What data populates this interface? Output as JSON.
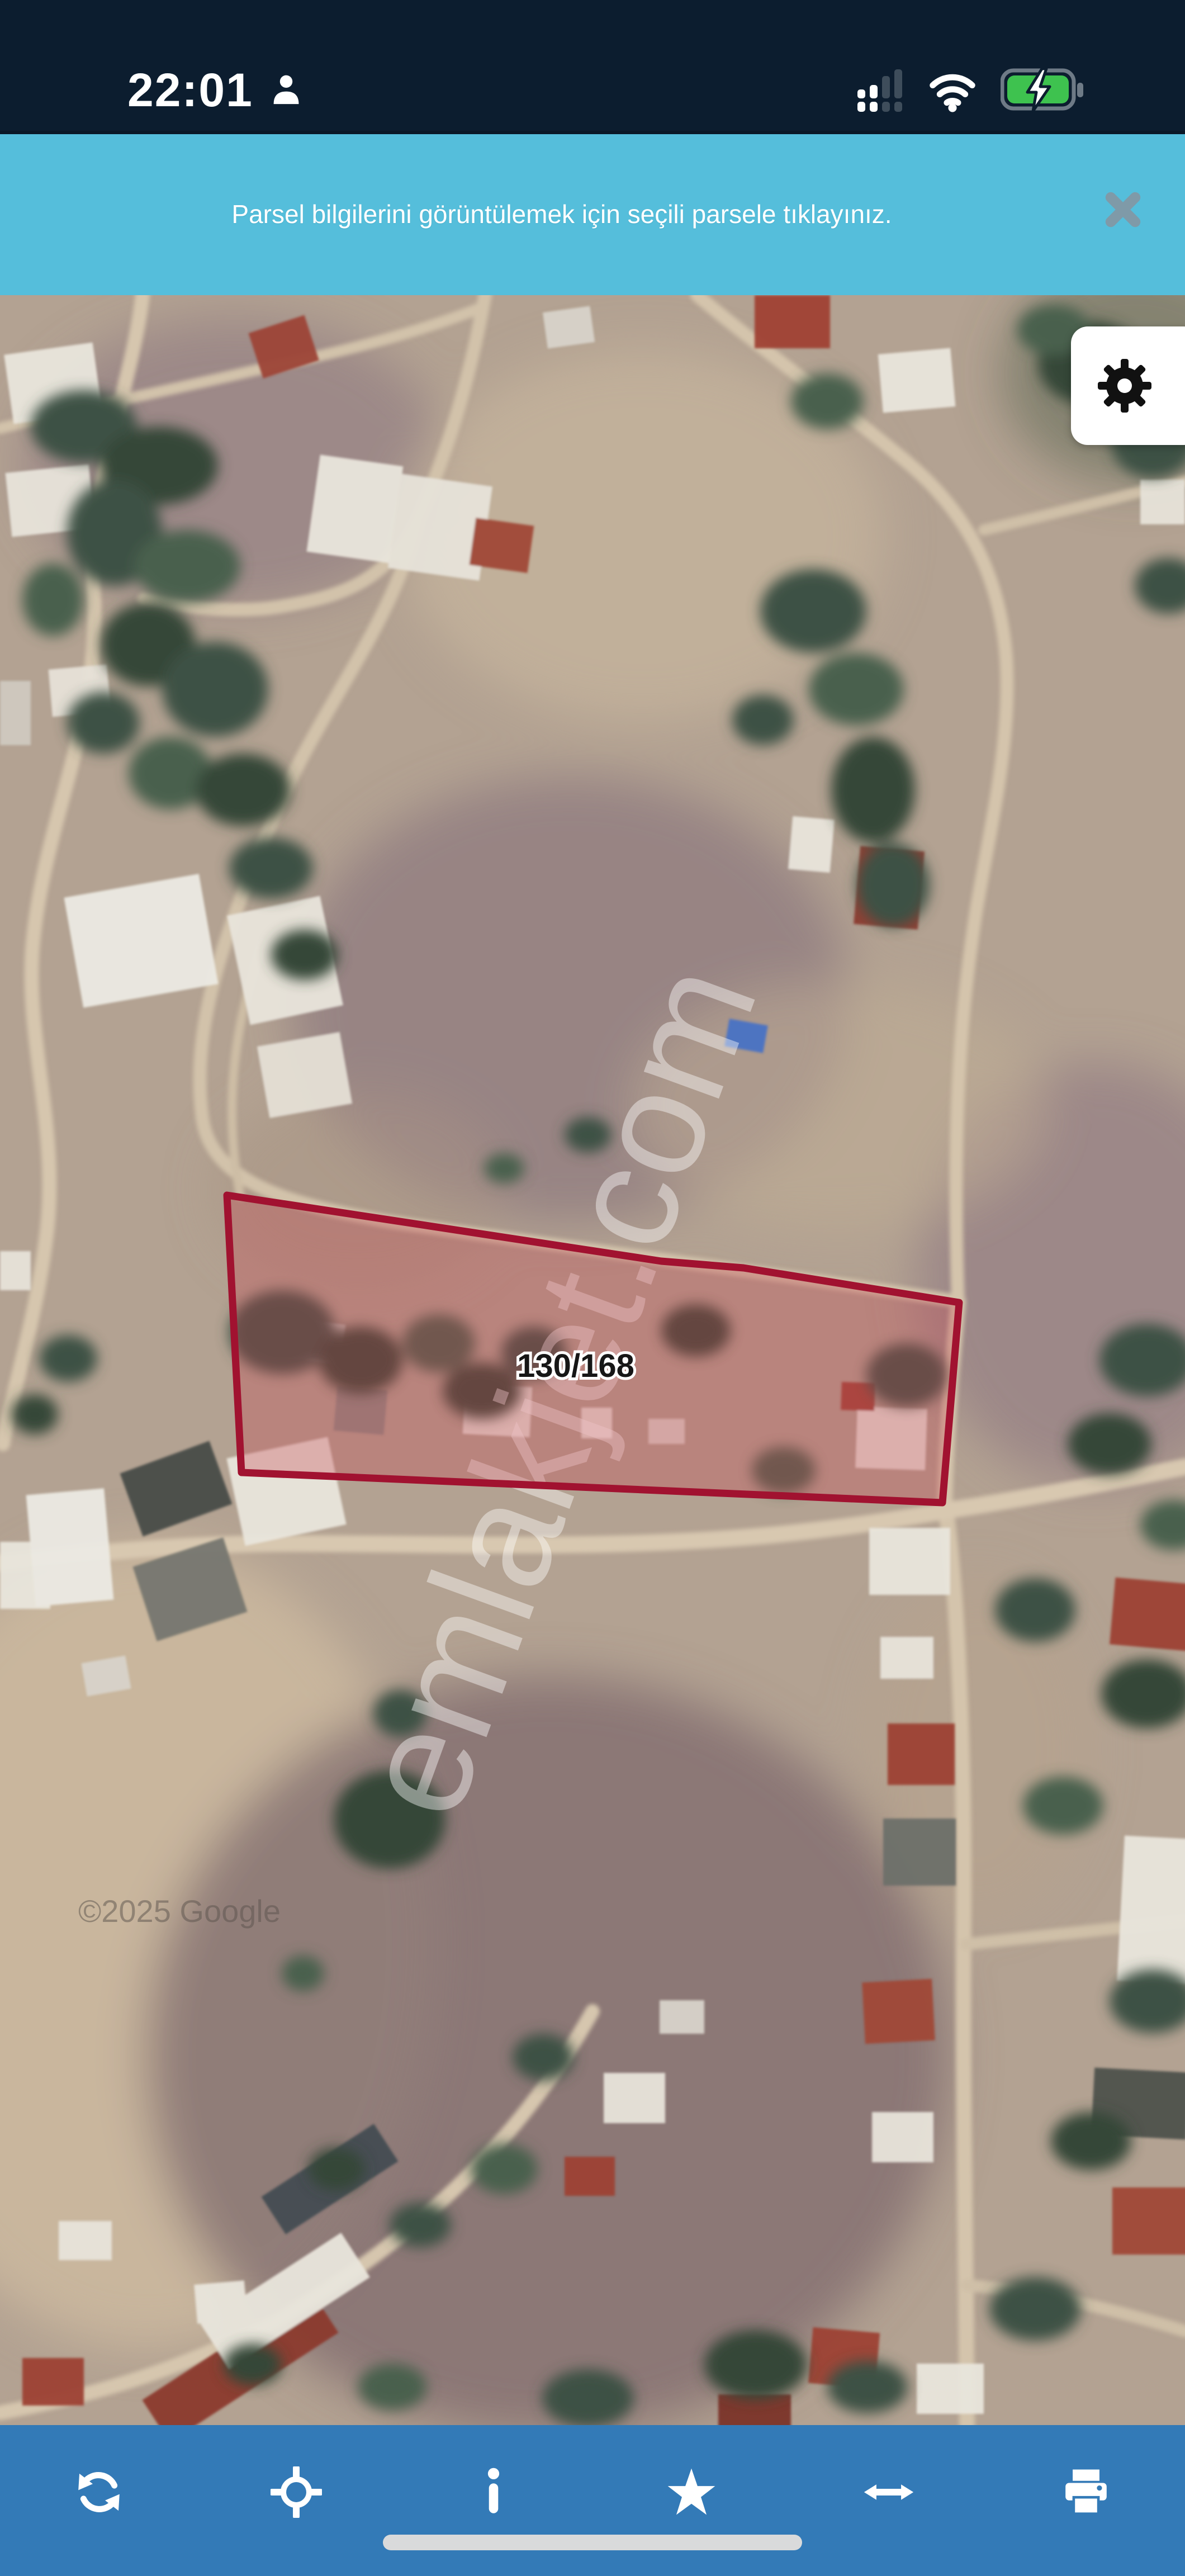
{
  "status_bar": {
    "time": "22:01",
    "icons": [
      {
        "name": "user-icon"
      },
      {
        "name": "cellular-signal-icon",
        "filled_bars": 2,
        "total_bars": 4
      },
      {
        "name": "wifi-icon"
      },
      {
        "name": "battery-charging-icon"
      }
    ],
    "colors": {
      "background": "#0c1d2f",
      "battery_green": "#3ec24f"
    }
  },
  "banner": {
    "message": "Parsel bilgilerini görüntülemek için seçili parsele tıklayınız.",
    "close_icon": "close-x-icon",
    "colors": {
      "background": "#55bedb",
      "text": "#ffffff",
      "close": "#7f9aa8"
    }
  },
  "map": {
    "type": "satellite",
    "parcel_label": "130/168",
    "watermark": "emlakjet.com",
    "attribution": "©2025 Google",
    "settings_icon": "gear-icon",
    "colors": {
      "parcel_outline": "#a11230",
      "parcel_fill": "rgba(198,68,80,0.32)"
    }
  },
  "toolbar": {
    "items": [
      {
        "name": "refresh-icon"
      },
      {
        "name": "locate-icon"
      },
      {
        "name": "info-icon"
      },
      {
        "name": "favorite-star-icon"
      },
      {
        "name": "resize-horizontal-icon"
      },
      {
        "name": "print-icon"
      }
    ],
    "colors": {
      "background": "#337ab7",
      "icon": "#ffffff"
    },
    "home_indicator": true
  }
}
